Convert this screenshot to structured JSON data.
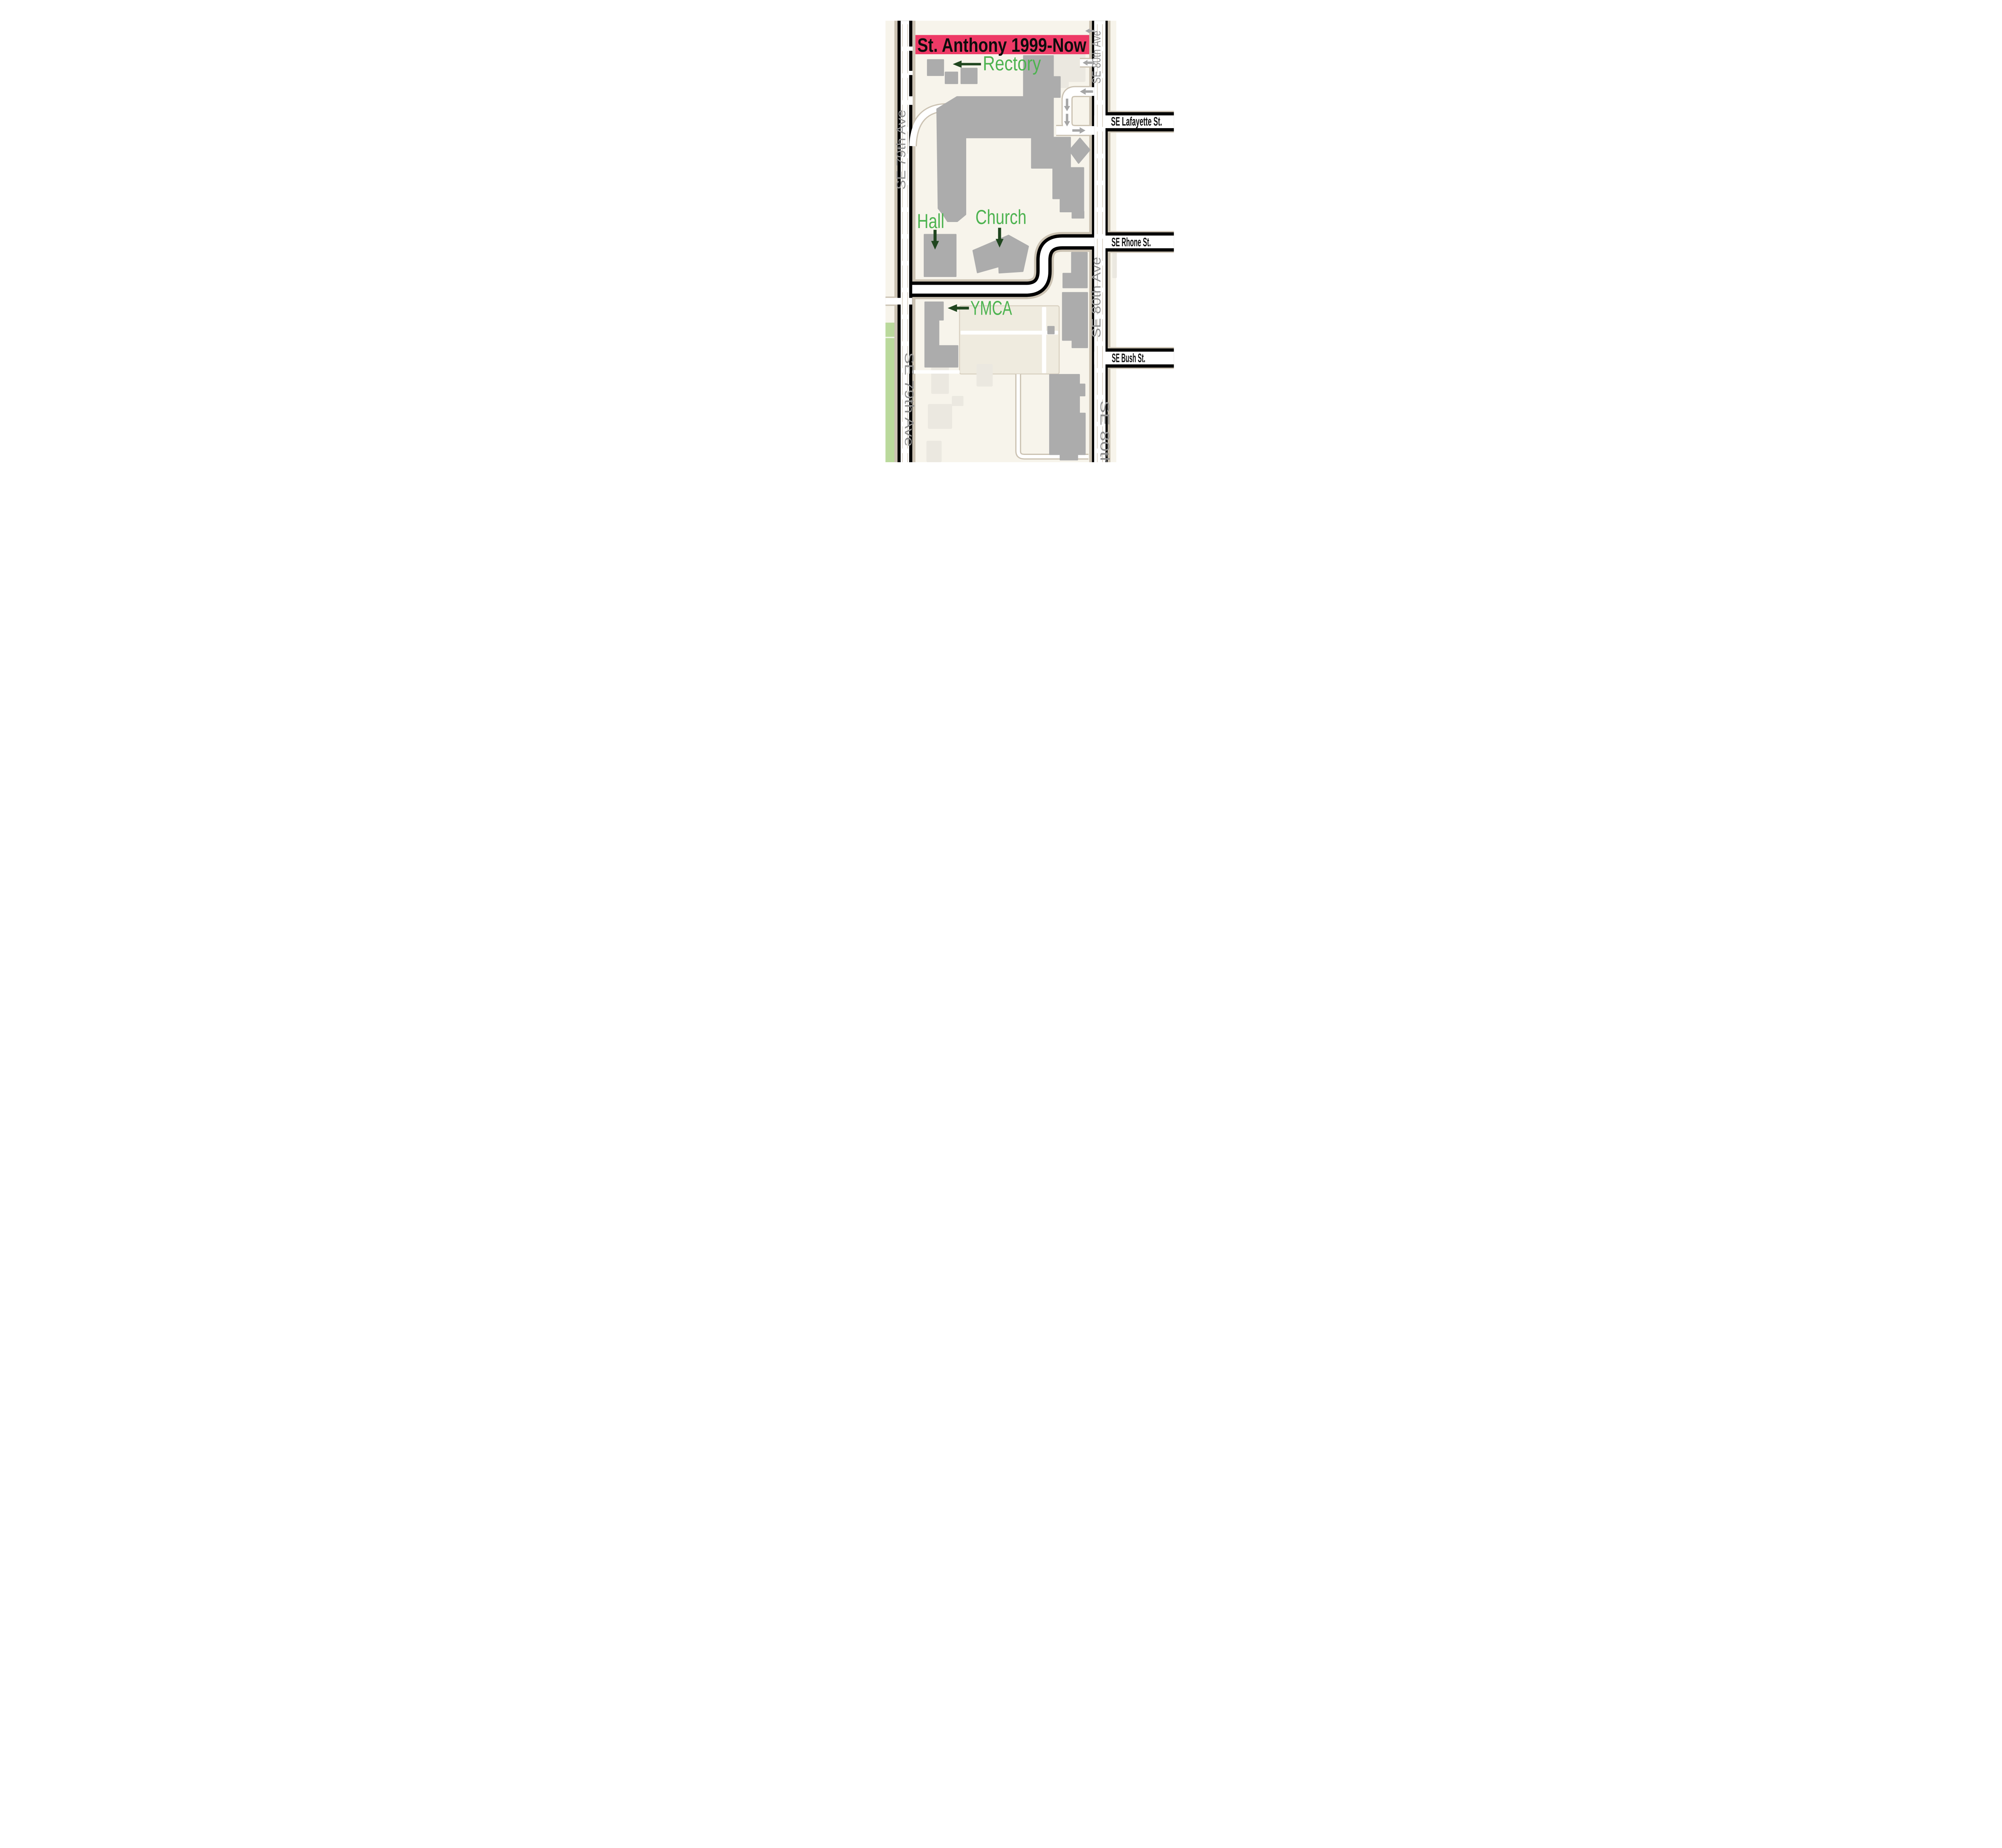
{
  "banner": {
    "label": "St. Anthony 1999-Now",
    "color": "#ee3a66",
    "text_color": "#0d0d0d"
  },
  "pois": {
    "rectory": {
      "label": "Rectory"
    },
    "hall": {
      "label": "Hall"
    },
    "church": {
      "label": "Church"
    },
    "ymca": {
      "label": "YMCA"
    }
  },
  "streets": {
    "se79th_upper": {
      "label": "SE 79th Ave"
    },
    "se79th_lower": {
      "label": "SE 79th Ave"
    },
    "se80th_upper": {
      "label": "SE 80th Ave"
    },
    "se80th_middle": {
      "label": "SE 80th Ave"
    },
    "se80th_lower": {
      "label": "SE 80th"
    },
    "lafayette": {
      "label": "SE Lafayette St."
    },
    "rhone": {
      "label": "SE Rhone St."
    },
    "bush": {
      "label": "SE Bush St."
    }
  },
  "colors": {
    "map_background": "#f7f4eb",
    "building": "#acacac",
    "building_light": "#ebe8e0",
    "parking": "#efebdf",
    "park": "#bad99c",
    "poi_label": "#4db350",
    "poi_arrow": "#20461f",
    "street_gray_label": "#8f8f8f",
    "oneway_arrow": "#a6a6a6",
    "street_casing": "#000000",
    "street_fill": "#ffffff",
    "street_edge_tan": "#cbc2b2"
  }
}
